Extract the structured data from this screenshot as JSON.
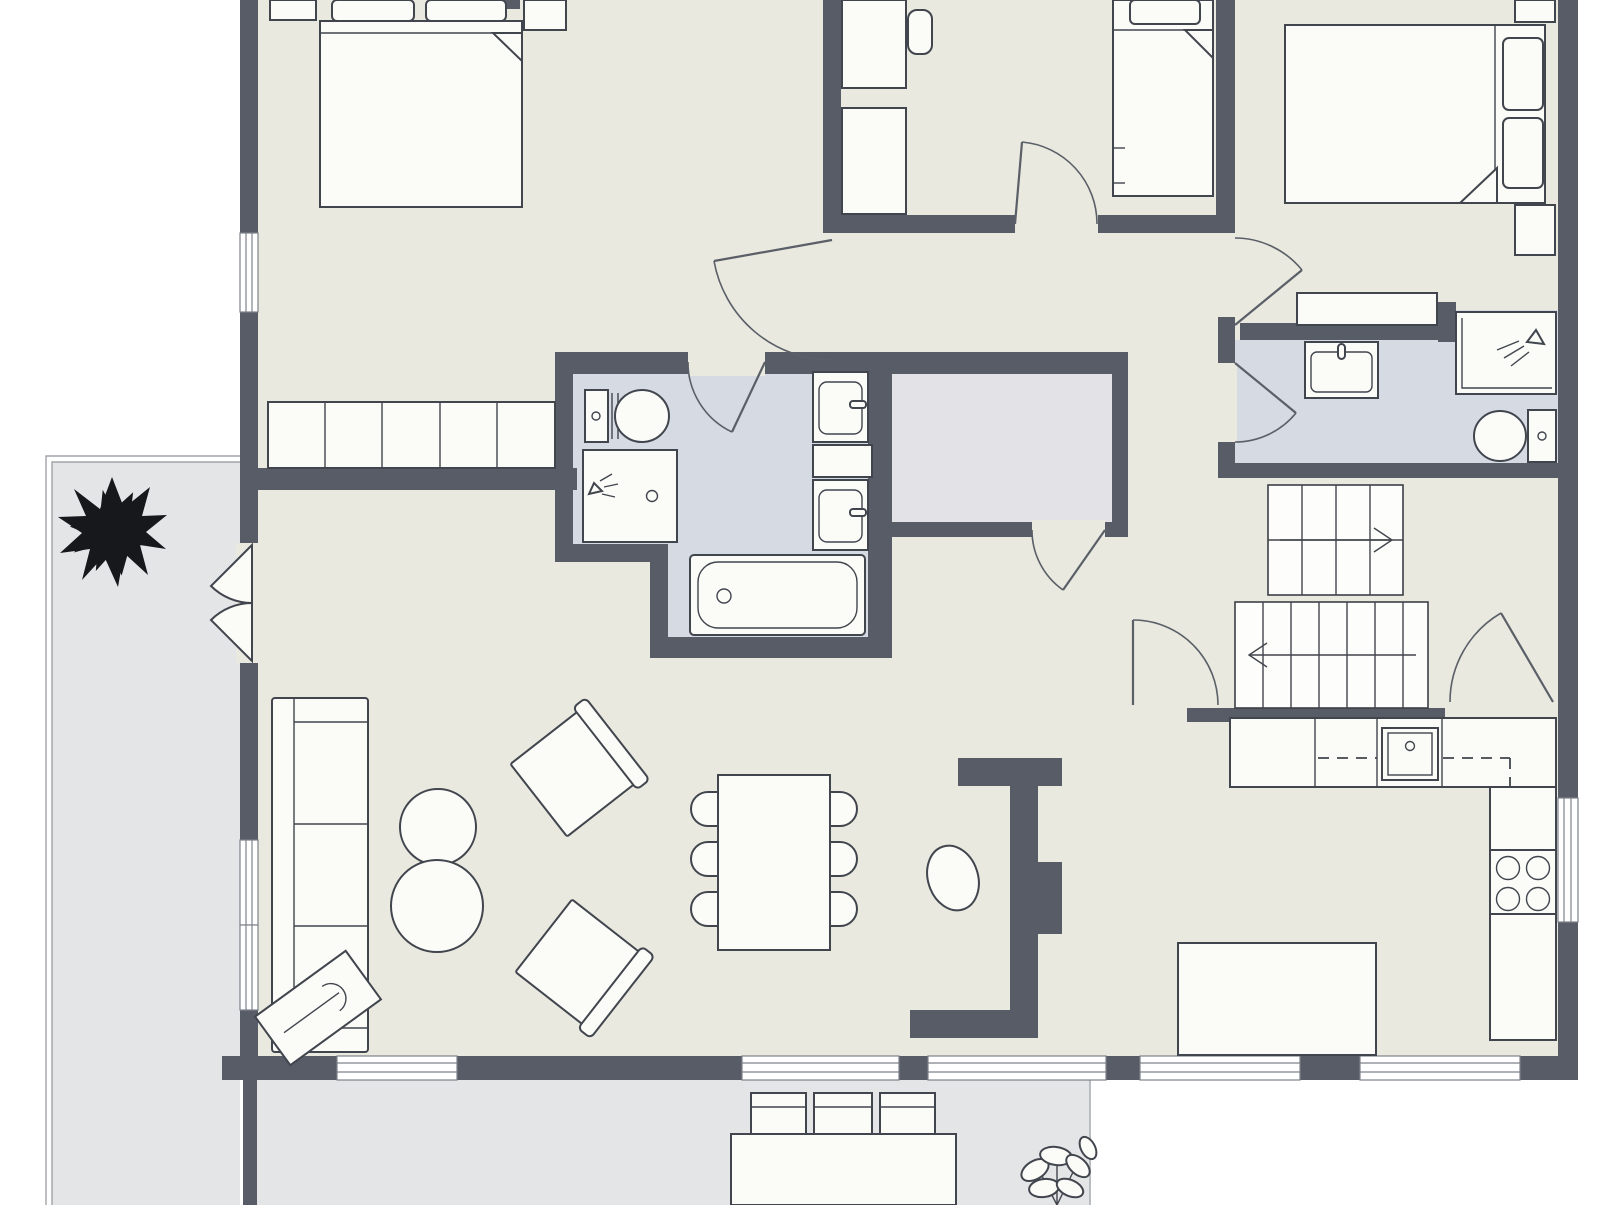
{
  "palette": {
    "background": "#ffffff",
    "wall": "#575c66",
    "floor_main": "#e9e9df",
    "floor_bathroom": "#d5dae3",
    "floor_storage": "#e3e3e7",
    "floor_terrace": "#e4e5e7",
    "furniture_fill": "#fbfbf8",
    "furniture_line": "#41454d",
    "door_line": "#5a5f68",
    "tree": "#17181b"
  },
  "plan": {
    "type": "residential-floor-plan-top-view",
    "visible_text": [],
    "rooms": [
      {
        "id": "bedroom-top-left",
        "floor": "main",
        "contents": [
          "double-bed",
          "pillows",
          "nightstand-left",
          "nightstand-right",
          "wardrobe-row-of-5",
          "window"
        ]
      },
      {
        "id": "bedroom-middle",
        "floor": "main",
        "contents": [
          "desk",
          "desk-chair",
          "dresser",
          "single-bed"
        ]
      },
      {
        "id": "bedroom-top-right",
        "floor": "main",
        "contents": [
          "double-bed",
          "pillows",
          "nightstand-top",
          "nightstand-bottom",
          "console-shelf"
        ]
      },
      {
        "id": "bathroom-central",
        "floor": "bathroom",
        "contents": [
          "toilet",
          "shower",
          "vanity-sink-upper",
          "shelf",
          "vanity-sink-lower",
          "bathtub"
        ]
      },
      {
        "id": "bathroom-right",
        "floor": "bathroom",
        "contents": [
          "vanity-sink",
          "shower",
          "toilet"
        ]
      },
      {
        "id": "storage-room",
        "floor": "storage",
        "contents": []
      },
      {
        "id": "hallway",
        "floor": "main",
        "contents": []
      },
      {
        "id": "stair-hall",
        "floor": "main",
        "contents": [
          "stairs-upper-flight",
          "stairs-lower-flight"
        ]
      },
      {
        "id": "living-room",
        "floor": "main",
        "contents": [
          "sofa-three-seat",
          "round-coffee-table-small",
          "round-coffee-table-large",
          "armchair-upper",
          "armchair-lower",
          "side-table-with-instrument"
        ]
      },
      {
        "id": "dining-area",
        "floor": "main",
        "contents": [
          "dining-table",
          "dining-chairs-left-3",
          "dining-chairs-right-3"
        ]
      },
      {
        "id": "kitchen",
        "floor": "main",
        "contents": [
          "counter-top-run",
          "kitchen-sink",
          "wall-cabinet-dashed-line",
          "counter-right-run",
          "cooktop-four-burners",
          "kitchen-island",
          "chimney-column",
          "hanging-chair"
        ]
      },
      {
        "id": "terrace-left",
        "floor": "terrace",
        "contents": [
          "evergreen-tree"
        ]
      },
      {
        "id": "terrace-bottom",
        "floor": "terrace",
        "contents": [
          "outdoor-table",
          "outdoor-chairs-3",
          "potted-plant"
        ]
      }
    ],
    "stairs": {
      "upper_flight_steps": 4,
      "lower_flight_steps": 7,
      "upper_arrow_direction": "right",
      "lower_arrow_direction": "left"
    },
    "doors": {
      "interior_swing_doors": 8,
      "double_french_doors": 2
    },
    "windows": {
      "left_wall": 3,
      "bottom_wall": 5,
      "right_wall": 1
    }
  }
}
